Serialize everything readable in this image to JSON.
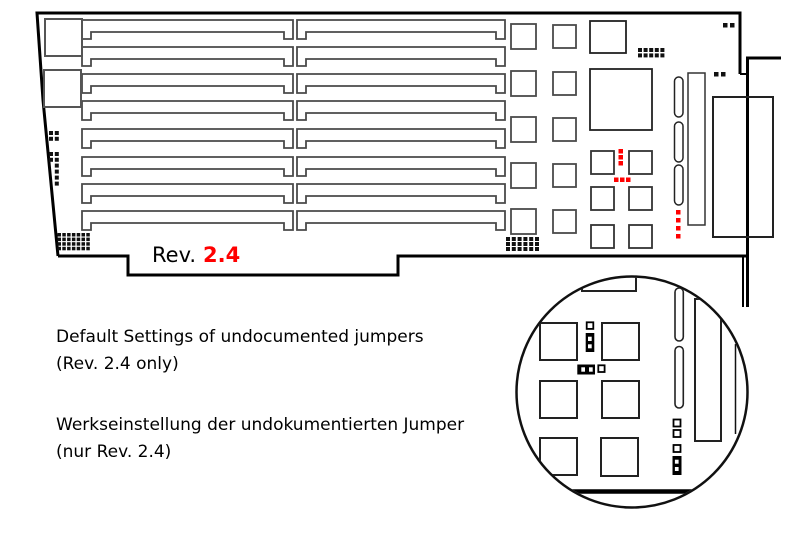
{
  "diagram": {
    "title": "PCB jumper diagram",
    "board_label_prefix": "Rev.",
    "board_revision": "2.4",
    "colors": {
      "accent": "#ff0000",
      "outline": "#000000",
      "component": "#444444"
    }
  },
  "captions": {
    "en_line1": "Default Settings of undocumented jumpers",
    "en_line2": "(Rev. 2.4 only)",
    "de_line1": "Werkseinstellung der undokumentierten Jumper",
    "de_line2": "(nur Rev. 2.4)"
  }
}
